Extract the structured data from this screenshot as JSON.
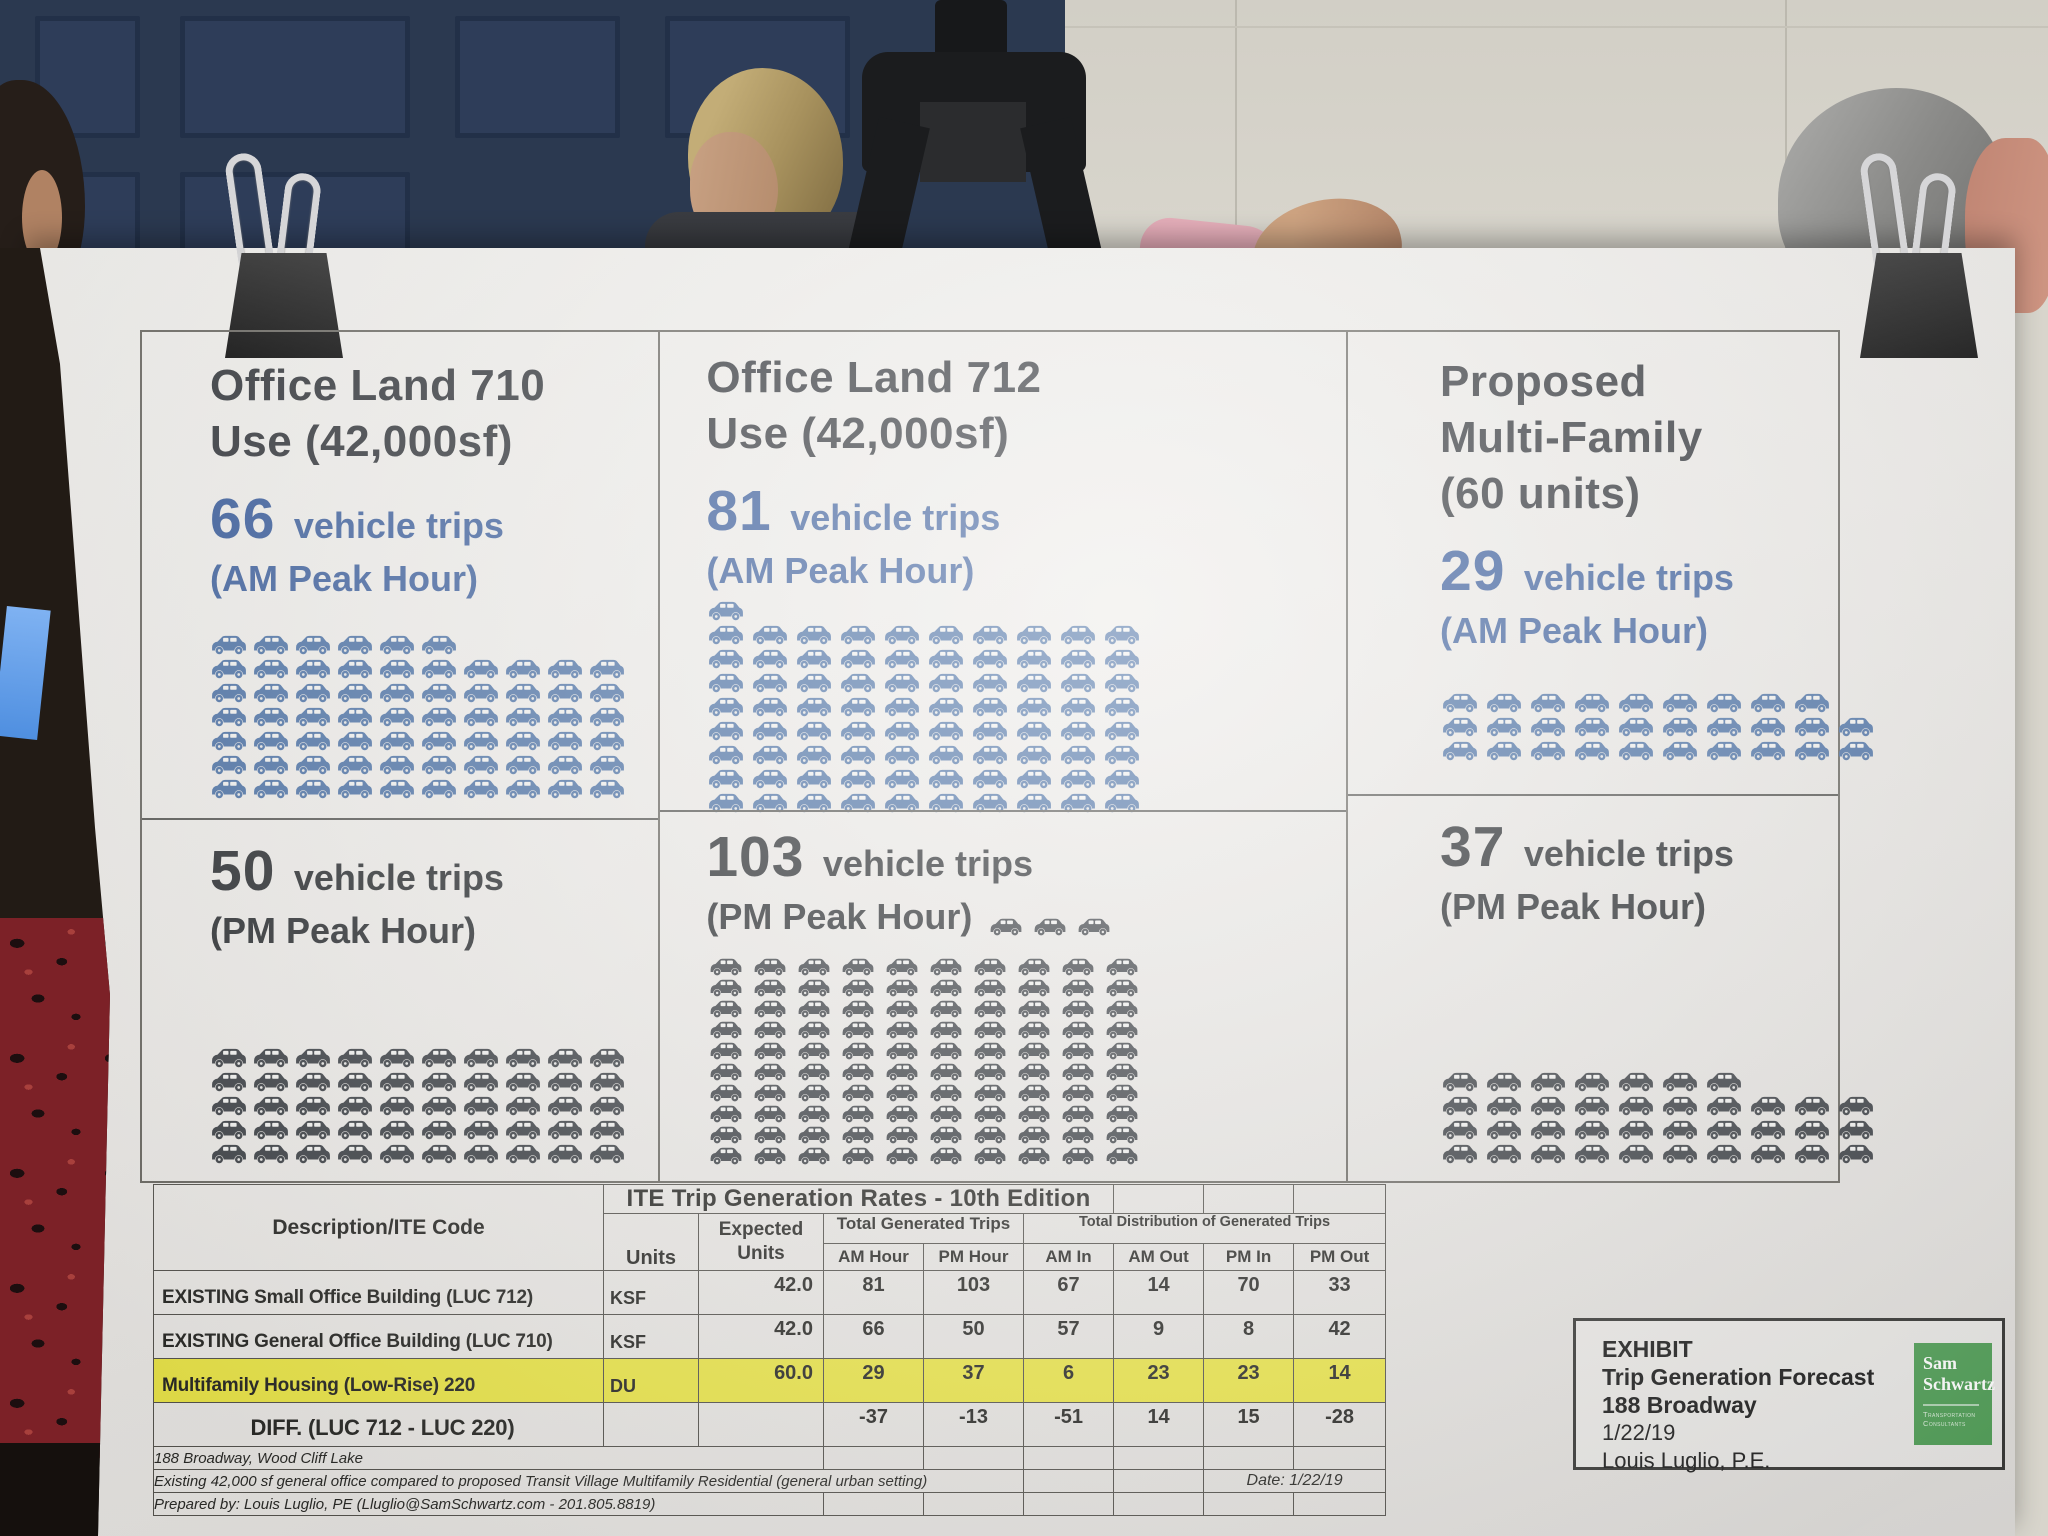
{
  "colors": {
    "am_car": "#4e73a6",
    "pm_car": "#3e4247",
    "am_text": "#3c5f9d",
    "pm_text": "#2e3134",
    "highlight": "#e9e44a",
    "logo_green": "#56a15c"
  },
  "panels": [
    {
      "title_lines": [
        "Office Land 710",
        "Use (42,000sf)"
      ],
      "am": {
        "count": "66",
        "label": "vehicle trips",
        "sub": "(AM Peak Hour)",
        "rows": [
          6,
          10,
          10,
          10,
          10,
          10,
          10
        ]
      },
      "pm": {
        "count": "50",
        "label": "vehicle trips",
        "sub": "(PM Peak Hour)",
        "rows": [
          10,
          10,
          10,
          10,
          10
        ]
      }
    },
    {
      "title_lines": [
        "Office Land 712",
        "Use (42,000sf)"
      ],
      "am": {
        "count": "81",
        "label": "vehicle trips",
        "sub": "(AM Peak Hour)",
        "rows": [
          1,
          10,
          10,
          10,
          10,
          10,
          10,
          10,
          10
        ]
      },
      "pm": {
        "count": "103",
        "label": "vehicle trips",
        "sub": "(PM Peak Hour)",
        "inline_rows": [
          3
        ],
        "rows": [
          10,
          10,
          10,
          10,
          10,
          10,
          10,
          10,
          10,
          10
        ]
      }
    },
    {
      "title_lines": [
        "Proposed",
        "Multi-Family",
        "(60 units)"
      ],
      "am": {
        "count": "29",
        "label": "vehicle trips",
        "sub": "(AM Peak Hour)",
        "rows": [
          9,
          10,
          10
        ]
      },
      "pm": {
        "count": "37",
        "label": "vehicle trips",
        "sub": "(PM Peak Hour)",
        "rows": [
          7,
          10,
          10,
          10
        ]
      }
    }
  ],
  "table": {
    "title": "ITE Trip Generation Rates  -  10th Edition",
    "col_desc": "Description/ITE Code",
    "col_units": "Units",
    "col_expected_line1": "Expected",
    "col_expected_line2": "Units",
    "group_generated": "Total Generated Trips",
    "group_distribution": "Total Distribution of Generated Trips",
    "subheaders": [
      "AM Hour",
      "PM Hour",
      "AM In",
      "AM Out",
      "PM In",
      "PM Out"
    ],
    "rows": [
      {
        "desc": "EXISTING Small Office Building (LUC 712)",
        "units": "KSF",
        "expected": "42.0",
        "values": [
          "81",
          "103",
          "67",
          "14",
          "70",
          "33"
        ],
        "highlight": false,
        "diff": false
      },
      {
        "desc": "EXISTING General Office Building (LUC 710)",
        "units": "KSF",
        "expected": "42.0",
        "values": [
          "66",
          "50",
          "57",
          "9",
          "8",
          "42"
        ],
        "highlight": false,
        "diff": false
      },
      {
        "desc": "Multifamily Housing (Low-Rise) 220",
        "units": "DU",
        "expected": "60.0",
        "values": [
          "29",
          "37",
          "6",
          "23",
          "23",
          "14"
        ],
        "highlight": true,
        "diff": false
      },
      {
        "desc": "DIFF. (LUC 712 - LUC 220)",
        "units": "",
        "expected": "",
        "values": [
          "-37",
          "-13",
          "-51",
          "14",
          "15",
          "-28"
        ],
        "highlight": false,
        "diff": true
      }
    ],
    "footnotes": [
      "188 Broadway, Wood Cliff Lake",
      "Existing 42,000 sf general office compared to proposed Transit Village Multifamily Residential (general urban setting)",
      "Prepared by: Louis Luglio, PE (Lluglio@SamSchwartz.com - 201.805.8819)"
    ],
    "date_note": "Date: 1/22/19"
  },
  "exhibit": {
    "line1": "EXHIBIT",
    "line2": "Trip Generation Forecast",
    "line3": "188 Broadway",
    "line4": "1/22/19",
    "line5": "Louis Luglio, P.E.",
    "logo_line1": "Sam",
    "logo_line2": "Schwartz",
    "logo_sub1": "Transportation",
    "logo_sub2": "Consultants"
  },
  "chart_data": [
    {
      "type": "pictograph",
      "title": "Trip Generation Forecast - 188 Broadway",
      "unit": "vehicle trips (1 car icon = 1 trip)",
      "categories": [
        "Office Land 710 Use (42,000sf)",
        "Office Land 712 Use (42,000sf)",
        "Proposed Multi-Family (60 units)"
      ],
      "series": [
        {
          "name": "AM Peak Hour",
          "values": [
            66,
            81,
            29
          ]
        },
        {
          "name": "PM Peak Hour",
          "values": [
            50,
            103,
            37
          ]
        }
      ]
    },
    {
      "type": "table",
      "title": "ITE Trip Generation Rates - 10th Edition",
      "columns": [
        "Description/ITE Code",
        "Units",
        "Expected Units",
        "AM Hour",
        "PM Hour",
        "AM In",
        "AM Out",
        "PM In",
        "PM Out"
      ],
      "rows": [
        [
          "EXISTING Small Office Building (LUC 712)",
          "KSF",
          42.0,
          81,
          103,
          67,
          14,
          70,
          33
        ],
        [
          "EXISTING General Office Building (LUC 710)",
          "KSF",
          42.0,
          66,
          50,
          57,
          9,
          8,
          42
        ],
        [
          "Multifamily Housing (Low-Rise) 220",
          "DU",
          60.0,
          29,
          37,
          6,
          23,
          23,
          14
        ],
        [
          "DIFF. (LUC 712 - LUC 220)",
          "",
          null,
          -37,
          -13,
          -51,
          14,
          15,
          -28
        ]
      ]
    }
  ]
}
